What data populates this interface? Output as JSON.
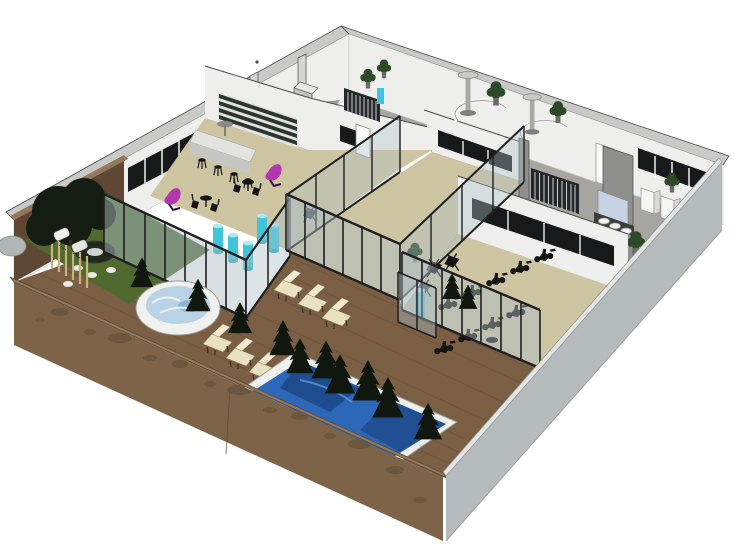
{
  "scene": {
    "kind": "3d-architectural-floorplan-render",
    "view": "aerial-isometric-cutaway",
    "subject": "spa-wellness-fitness-center",
    "background": "#ffffff"
  },
  "colors": {
    "background": "#ffffff",
    "wall_white": "#eeefed",
    "wall_cap": "#c9cac8",
    "wall_gray_face": "#8f8f8d",
    "exterior_gray": "#b5babc",
    "exterior_gray_edge": "#e4e5e3",
    "wood_wall": "#7d6449",
    "wood_wall_dark": "#5e4834",
    "wood_cap": "#94795c",
    "wood_deck": "#7a5f45",
    "deck_plank": "#684f39",
    "floor_tan": "#cdc4a2",
    "floor_gray": "#a6a59f",
    "grass": "#50692f",
    "foliage": "#161d12",
    "conifer": "#10170e",
    "bamboo": "#c9b37b",
    "pool_rim": "#eef0ee",
    "pool_water": "#2c67b8",
    "pool_water_dark": "#14386e",
    "pool_water_light": "#5e93d6",
    "hot_tub_water": "#b9d2e4",
    "glass": "#aebfc6",
    "glass_frame": "#1f1f1f",
    "cyan_column": "#3fc4da",
    "magenta_chair": "#b437ac",
    "lounge_cream": "#eae1c0",
    "equipment_black": "#141414",
    "window_dark": "#17191b",
    "shelf_dark": "#2c3530",
    "mirror_blue": "#c6d2e4",
    "plant_green": "#2c4a27",
    "stone_white": "#e8e8e4",
    "rock_gray": "#b0b6b6",
    "door_white": "#fafafa"
  },
  "inventory": {
    "outdoor": {
      "swimming_pool": 1,
      "hot_tub": 1,
      "lounge_chairs": 6,
      "fire_pit": 1,
      "garden_tree": 1,
      "bamboo_stalks": 6,
      "conifer_shrubs": 12,
      "boulder": 1,
      "garden_stones": 4,
      "outdoor_seats": 2
    },
    "cafe_bar": {
      "bar_counter": 1,
      "bar_stools": 4,
      "wall_shelf_rows": 4,
      "bistro_sets": 2,
      "magenta_recliners": 2,
      "wall_tv": 1
    },
    "spa": {
      "circular_showers": 2,
      "cyan_hydro_columns": 6,
      "glass_partition_walls": 7
    },
    "gym": {
      "spin_bikes": 9,
      "folding_chairs": 3,
      "window_bands": 4
    },
    "locker_washroom": {
      "locker_banks": 2,
      "sinks": 3,
      "mirror": 1,
      "toilet_stalls": 3,
      "potted_plants": 7,
      "interior_doors": 2
    }
  }
}
